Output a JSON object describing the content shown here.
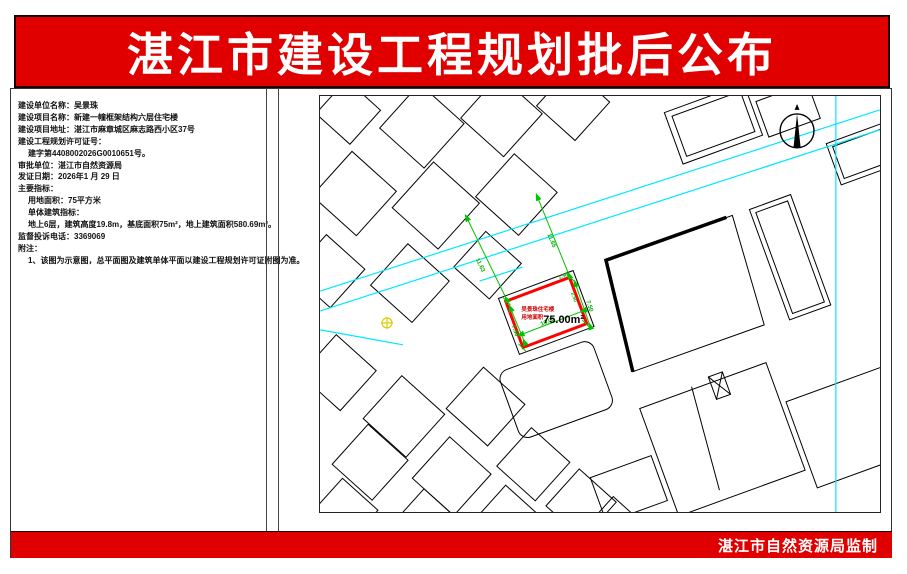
{
  "banner": {
    "title": "湛江市建设工程规划批后公布",
    "bg_color": "#e00000",
    "text_color": "#ffffff"
  },
  "footer": {
    "label": "湛江市自然资源局监制",
    "bg_color": "#e00000"
  },
  "info_panel": {
    "lines": [
      {
        "text": "建设单位名称：吴景珠",
        "indent": 0
      },
      {
        "text": "建设项目名称：新建一幢框架结构六层住宅楼",
        "indent": 0
      },
      {
        "text": "建设项目地址：湛江市麻章城区麻志路西小区37号",
        "indent": 0
      },
      {
        "text": "建设工程规划许可证号：",
        "indent": 0
      },
      {
        "text": "建字第4408002026G0010651号。",
        "indent": 1
      },
      {
        "text": "审批单位：湛江市自然资源局",
        "indent": 0
      },
      {
        "text": "发证日期：2026年1 月 29 日",
        "indent": 0
      },
      {
        "text": "主要指标：",
        "indent": 0
      },
      {
        "text": "用地面积：75平方米",
        "indent": 1
      },
      {
        "text": "单体建筑指标：",
        "indent": 1
      },
      {
        "text": "地上6层，建筑高度19.8m，基底面积75m²，地上建筑面积580.69m²。",
        "indent": 1
      },
      {
        "text": "监督投诉电话：3369069",
        "indent": 0
      },
      {
        "text": "附注：",
        "indent": 0
      },
      {
        "text": "1、该图为示意图，总平面图及建筑单体平面以建设工程规划许可证附图为准。",
        "indent": 1
      }
    ]
  },
  "map": {
    "plot_label_line1": "吴景珠住宅楼",
    "plot_label_line2": "用地面积",
    "plot_area_value": "75.00m²",
    "dimensions": {
      "offset_left": "11.63",
      "offset_right": "11.65",
      "edge_long": "10.00",
      "edge_short": "7.50",
      "setback_a": "2.50",
      "setback_b": "1.50"
    },
    "colors": {
      "road": "#00e8ff",
      "dimension": "#00c300",
      "plot_outline": "#ff0000",
      "utility_marker": "#ddcc00"
    }
  }
}
